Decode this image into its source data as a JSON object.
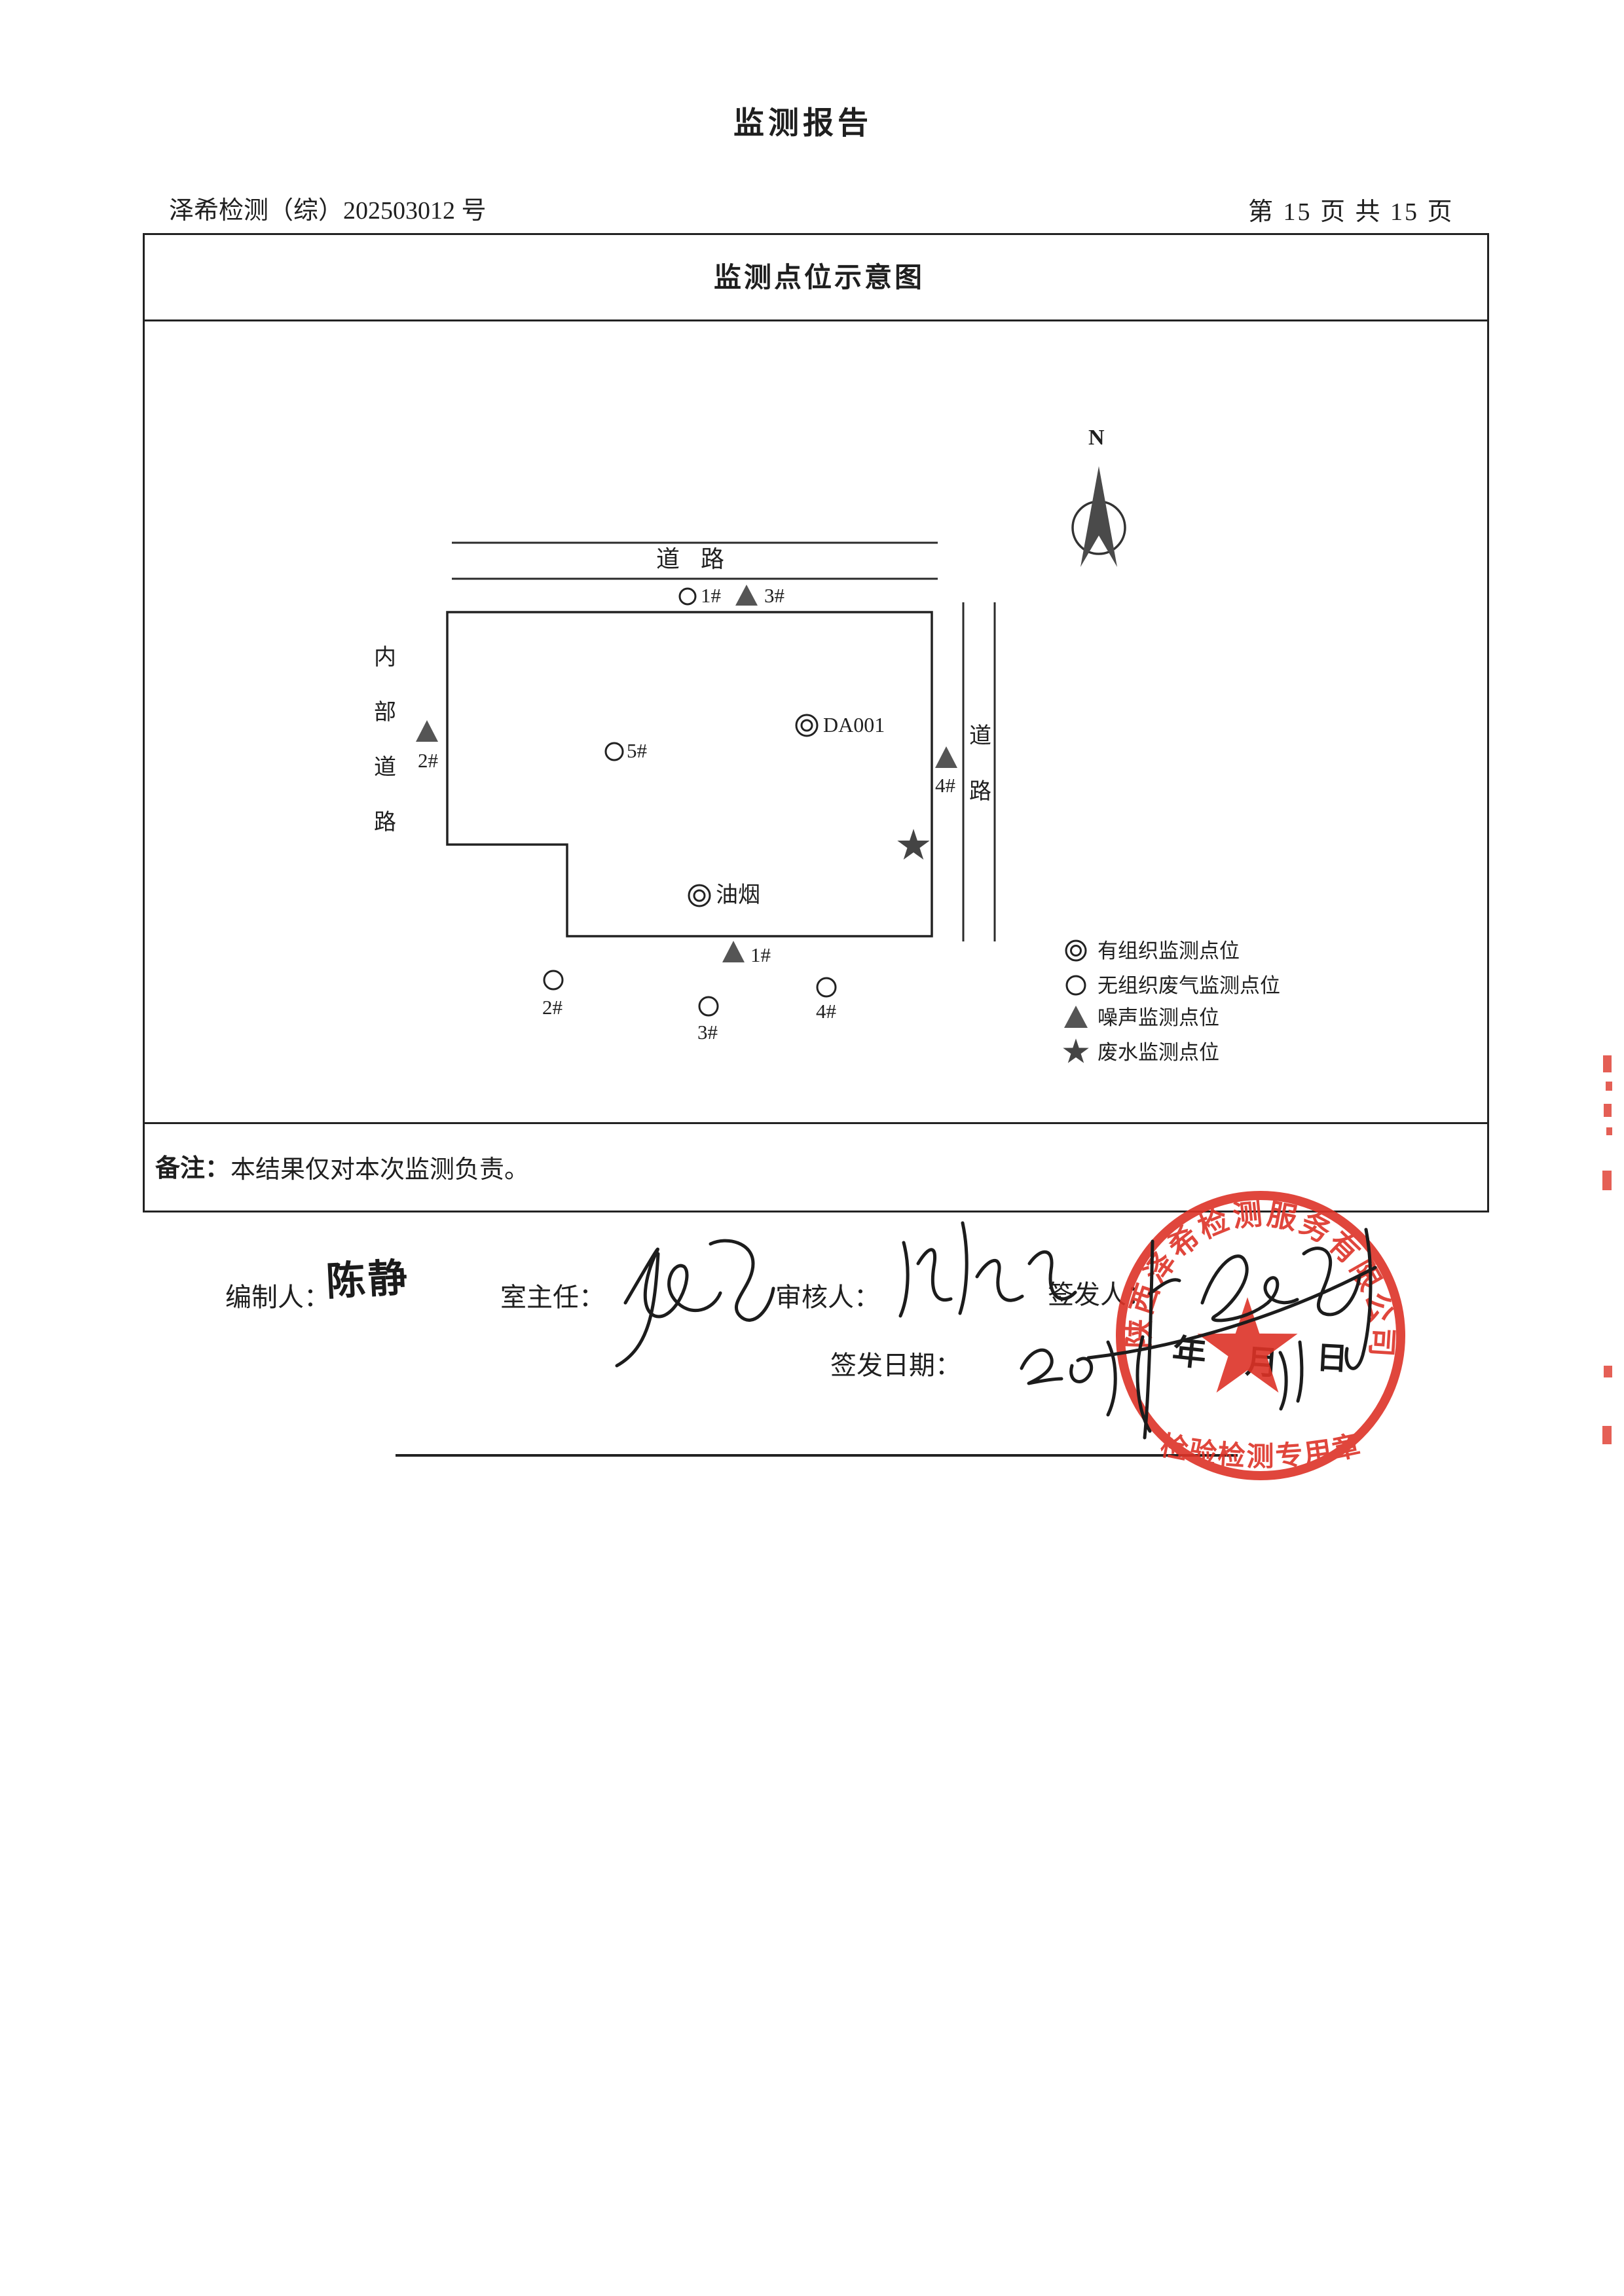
{
  "document": {
    "title": "监测报告",
    "report_no": "泽希检测（综）202503012 号",
    "page_info": "第 15 页 共 15 页"
  },
  "figure": {
    "title": "监测点位示意图",
    "north_label": "N",
    "top_road_label": "道路",
    "left_road_chars": [
      "内",
      "部",
      "道",
      "路"
    ],
    "right_road_chars": [
      "道",
      "路"
    ],
    "points": {
      "top_gas": "1#",
      "top_noise": "3#",
      "west_noise": "2#",
      "inside_gas": "5#",
      "stack": "DA001",
      "fume": "油烟",
      "east_noise": "4#",
      "south_noise": "1#",
      "south_gas_2": "2#",
      "south_gas_3": "3#",
      "south_gas_4": "4#"
    },
    "legend": [
      {
        "icon": "double-circle-icon",
        "label": "有组织监测点位"
      },
      {
        "icon": "circle-icon",
        "label": "无组织废气监测点位"
      },
      {
        "icon": "triangle-icon",
        "label": "噪声监测点位"
      },
      {
        "icon": "star-icon",
        "label": "废水监测点位"
      }
    ]
  },
  "note": {
    "label": "备注：",
    "text": "本结果仅对本次监测负责。"
  },
  "signatures": {
    "prepared_label": "编制人：",
    "prepared_name": "陈静",
    "room_director_label": "室主任：",
    "reviewer_label": "审核人：",
    "issuer_label": "签发人：",
    "issue_date_label": "签发日期：",
    "date_year_char": "年",
    "date_month_char": "月",
    "date_day_char": "日"
  },
  "stamp": {
    "company": "陕西泽希检测服务有限公司",
    "type_label": "检验检测专用章"
  },
  "colors": {
    "stamp_red": "#dd3327",
    "ink": "#1f1f1f"
  }
}
